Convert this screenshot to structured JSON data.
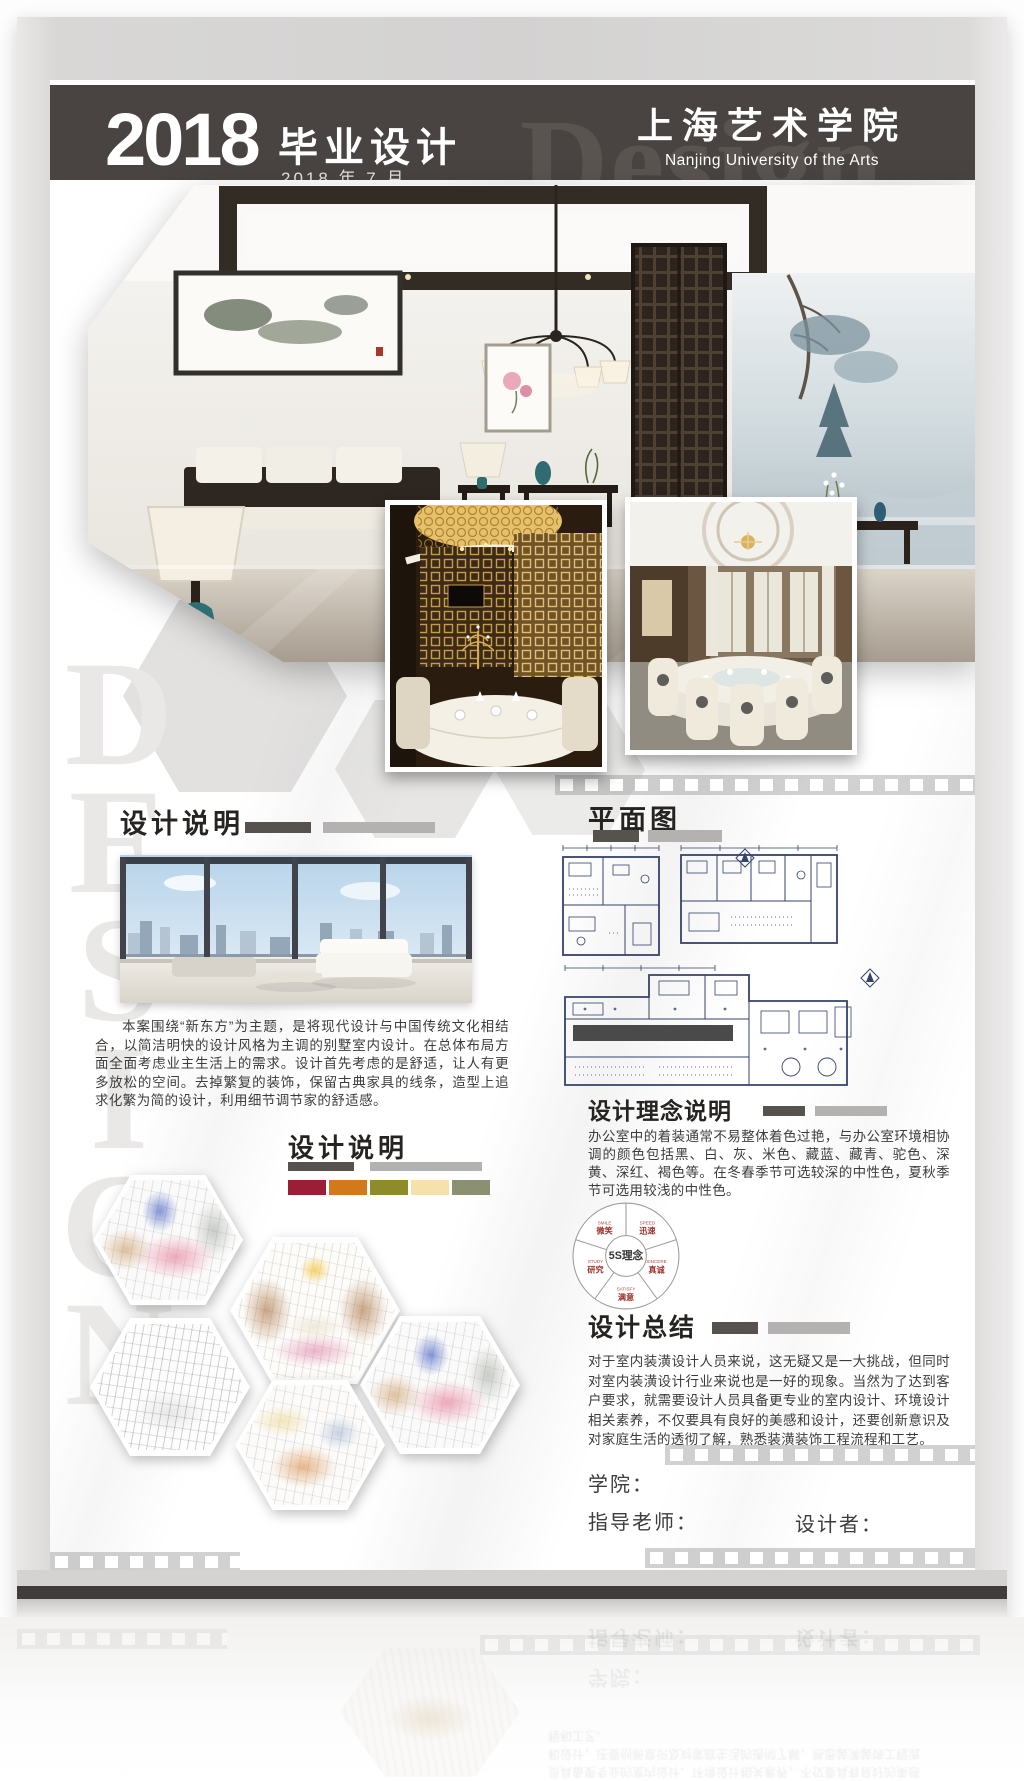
{
  "header": {
    "year": "2018",
    "title": "毕业设计",
    "date": "2018 年 7 月",
    "school_cn": "上海艺术学院",
    "school_en": "Nanjing University of the Arts",
    "watermark": "Design"
  },
  "watermark_letters": [
    "D",
    "E",
    "S",
    "I",
    "G",
    "N"
  ],
  "left": {
    "desc1": {
      "title": "设计说明",
      "body": "本案围绕“新东方”为主题，是将现代设计与中国传统文化相结合，以简洁明快的设计风格为主调的别墅室内设计。在总体布局方面全面考虑业主生活上的需求。设计首先考虑的是舒适，让人有更多放松的空间。去掉繁复的装饰，保留古典家具的线条，造型上追求化繁为简的设计，利用细节调节家的舒适感。"
    },
    "desc2": {
      "title": "设计说明"
    },
    "palette": [
      "#9b1e37",
      "#d2791c",
      "#8e8b2b",
      "#f7e1ab",
      "#8c9072"
    ]
  },
  "right": {
    "plan": {
      "title": "平面图"
    },
    "concept": {
      "title": "设计理念说明",
      "body": "办公室中的着装通常不易整体着色过艳，与办公室环境相协调的颜色包括黑、白、灰、米色、藏蓝、藏青、驼色、深黄、深红、褐色等。在冬春季节可选较深的中性色，夏秋季节可选用较浅的中性色。"
    },
    "five_s": {
      "center": "5S理念",
      "items": [
        {
          "en": "SMILE",
          "cn": "微笑"
        },
        {
          "en": "SPEED",
          "cn": "迅速"
        },
        {
          "en": "SINCERE",
          "cn": "真诚"
        },
        {
          "en": "SATISFY",
          "cn": "满意"
        },
        {
          "en": "STUDY",
          "cn": "研究"
        }
      ]
    },
    "summary": {
      "title": "设计总结",
      "body": "对于室内装潢设计人员来说，这无疑又是一大挑战，但同时对室内装潢设计行业来说也是一好的现象。当然为了达到客户要求，就需要设计人员具备更专业的室内设计、环境设计相关素养，不仅要具有良好的美感和设计，还要创新意识及对家庭生活的透彻了解，熟悉装潢装饰工程流程和工艺。"
    },
    "credits": {
      "college": "学院：",
      "advisor": "指导老师：",
      "designer": "设计者："
    }
  },
  "colors": {
    "header_bg": "#494442",
    "bar_dark": "#56524e",
    "bar_light": "#b3b2b1"
  }
}
